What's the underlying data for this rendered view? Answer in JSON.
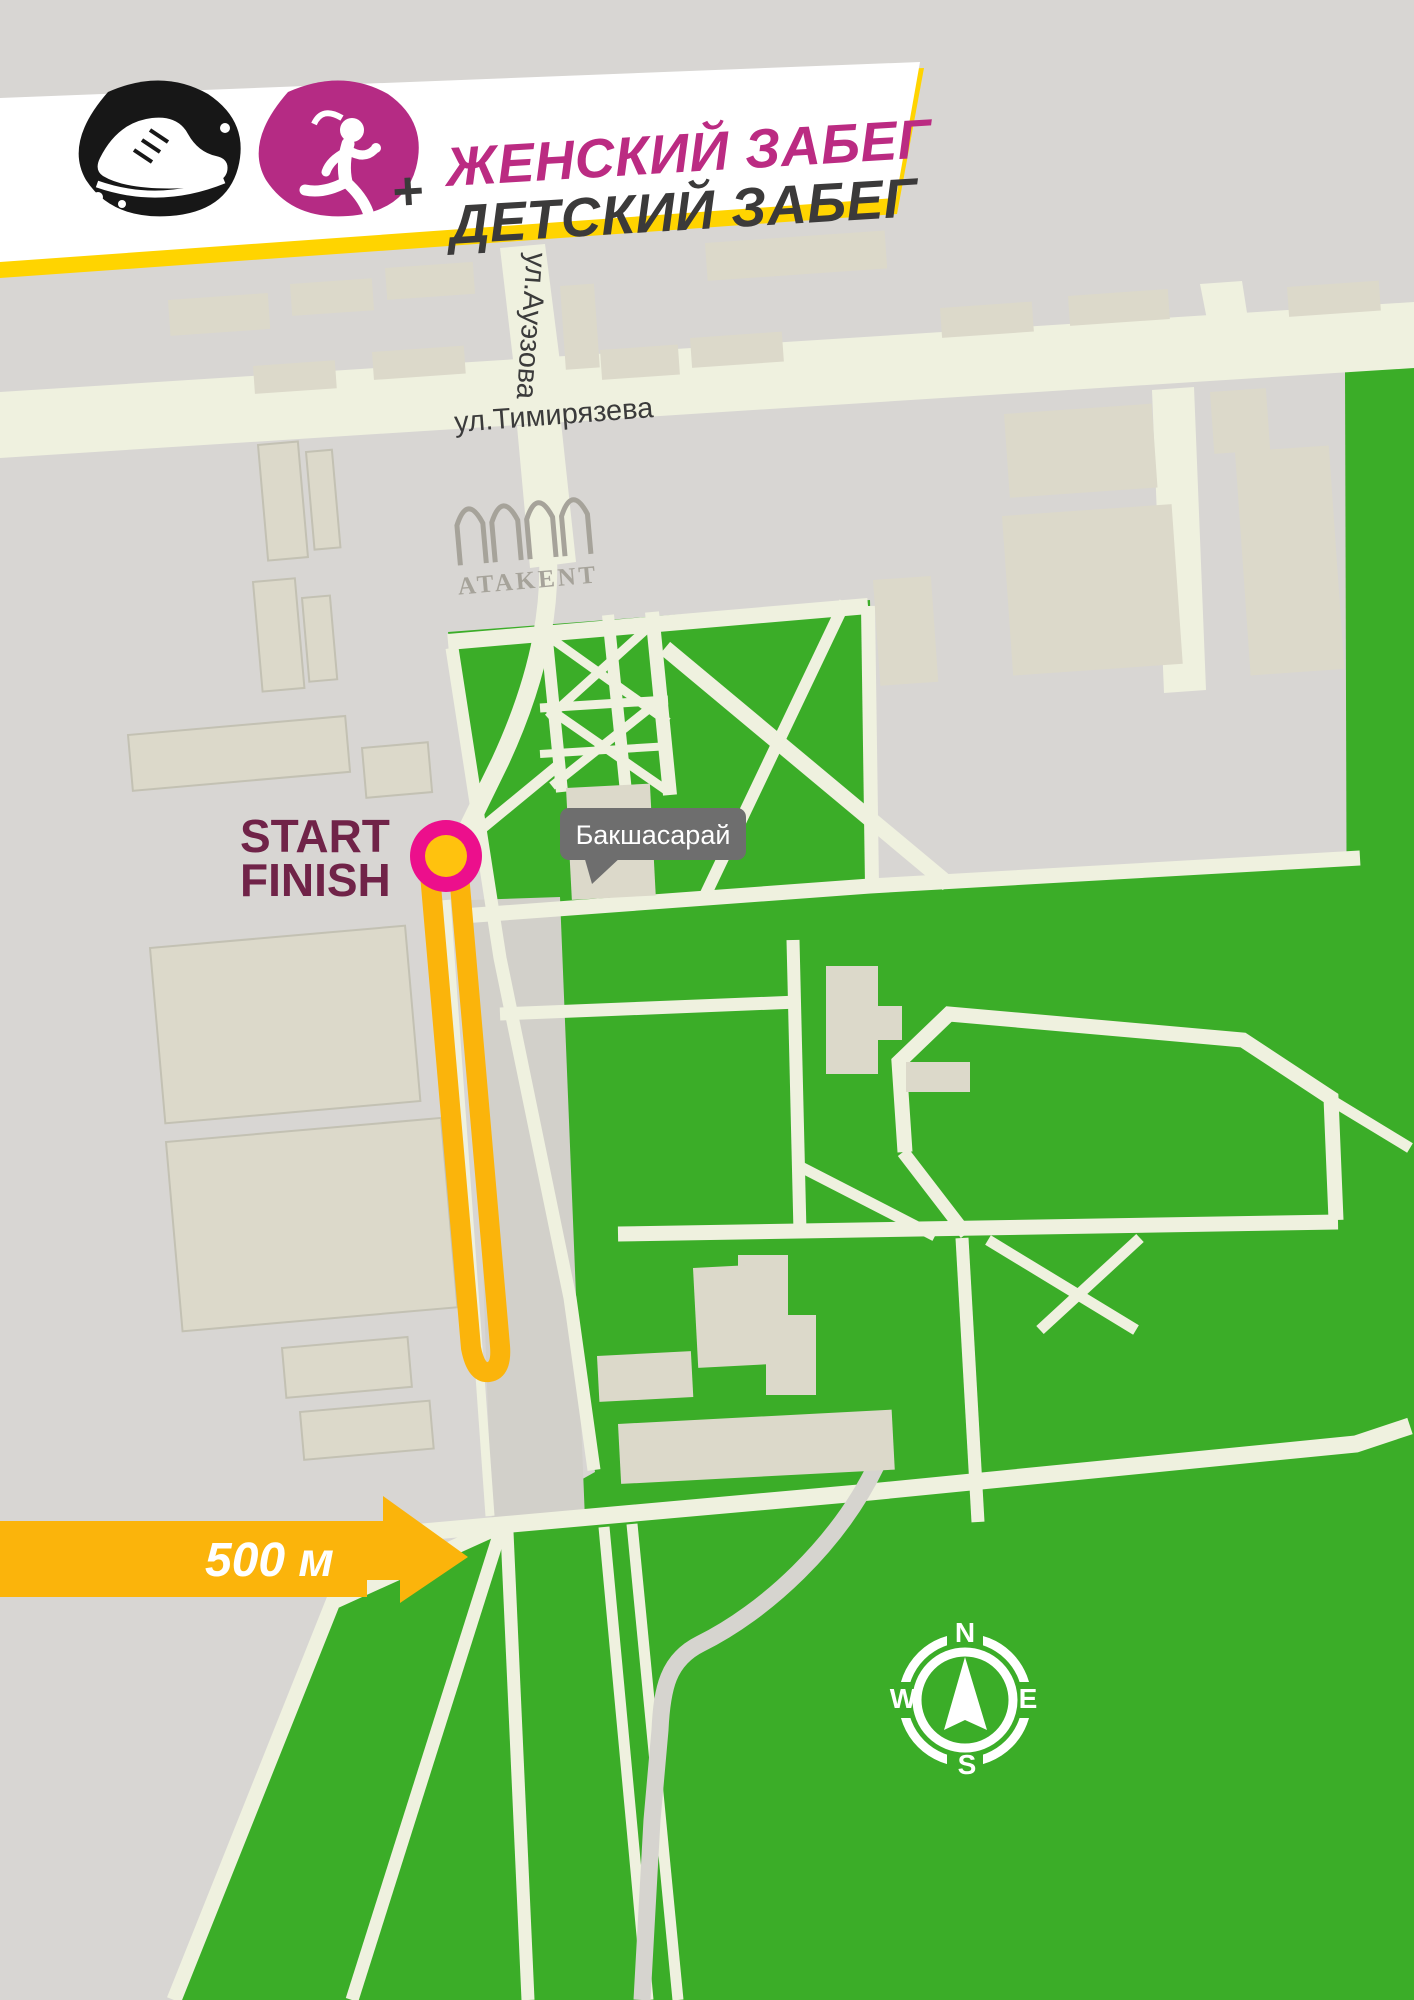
{
  "banner": {
    "plus_sign": "+",
    "line1": "ЖЕНСКИЙ ЗАБЕГ",
    "line2": "ДЕТСКИЙ ЗАБЕГ",
    "accent_color": "#bb2b82",
    "dark_color": "#3b3a3a",
    "border_color": "#ffd400"
  },
  "map": {
    "background_color": "#d8d6d3",
    "park_color": "#3bad28",
    "road_color": "#eff1df",
    "route_color": "#fbb40b",
    "streets": {
      "horizontal": "ул.Тимирязева",
      "vertical": "ул.Ауэзова"
    },
    "venue": {
      "logo_text": "ATAKENT"
    },
    "poi": {
      "label": "Бакшасарай"
    },
    "start_finish": {
      "line1": "START",
      "line2": "FINISH",
      "text_color": "#702348",
      "marker_ring_color": "#ec0f8c",
      "marker_center_color": "#ffc20e"
    },
    "distance_marker": {
      "label": "500 м"
    },
    "compass": {
      "north": "N",
      "east": "E",
      "south": "S",
      "west": "W"
    }
  }
}
